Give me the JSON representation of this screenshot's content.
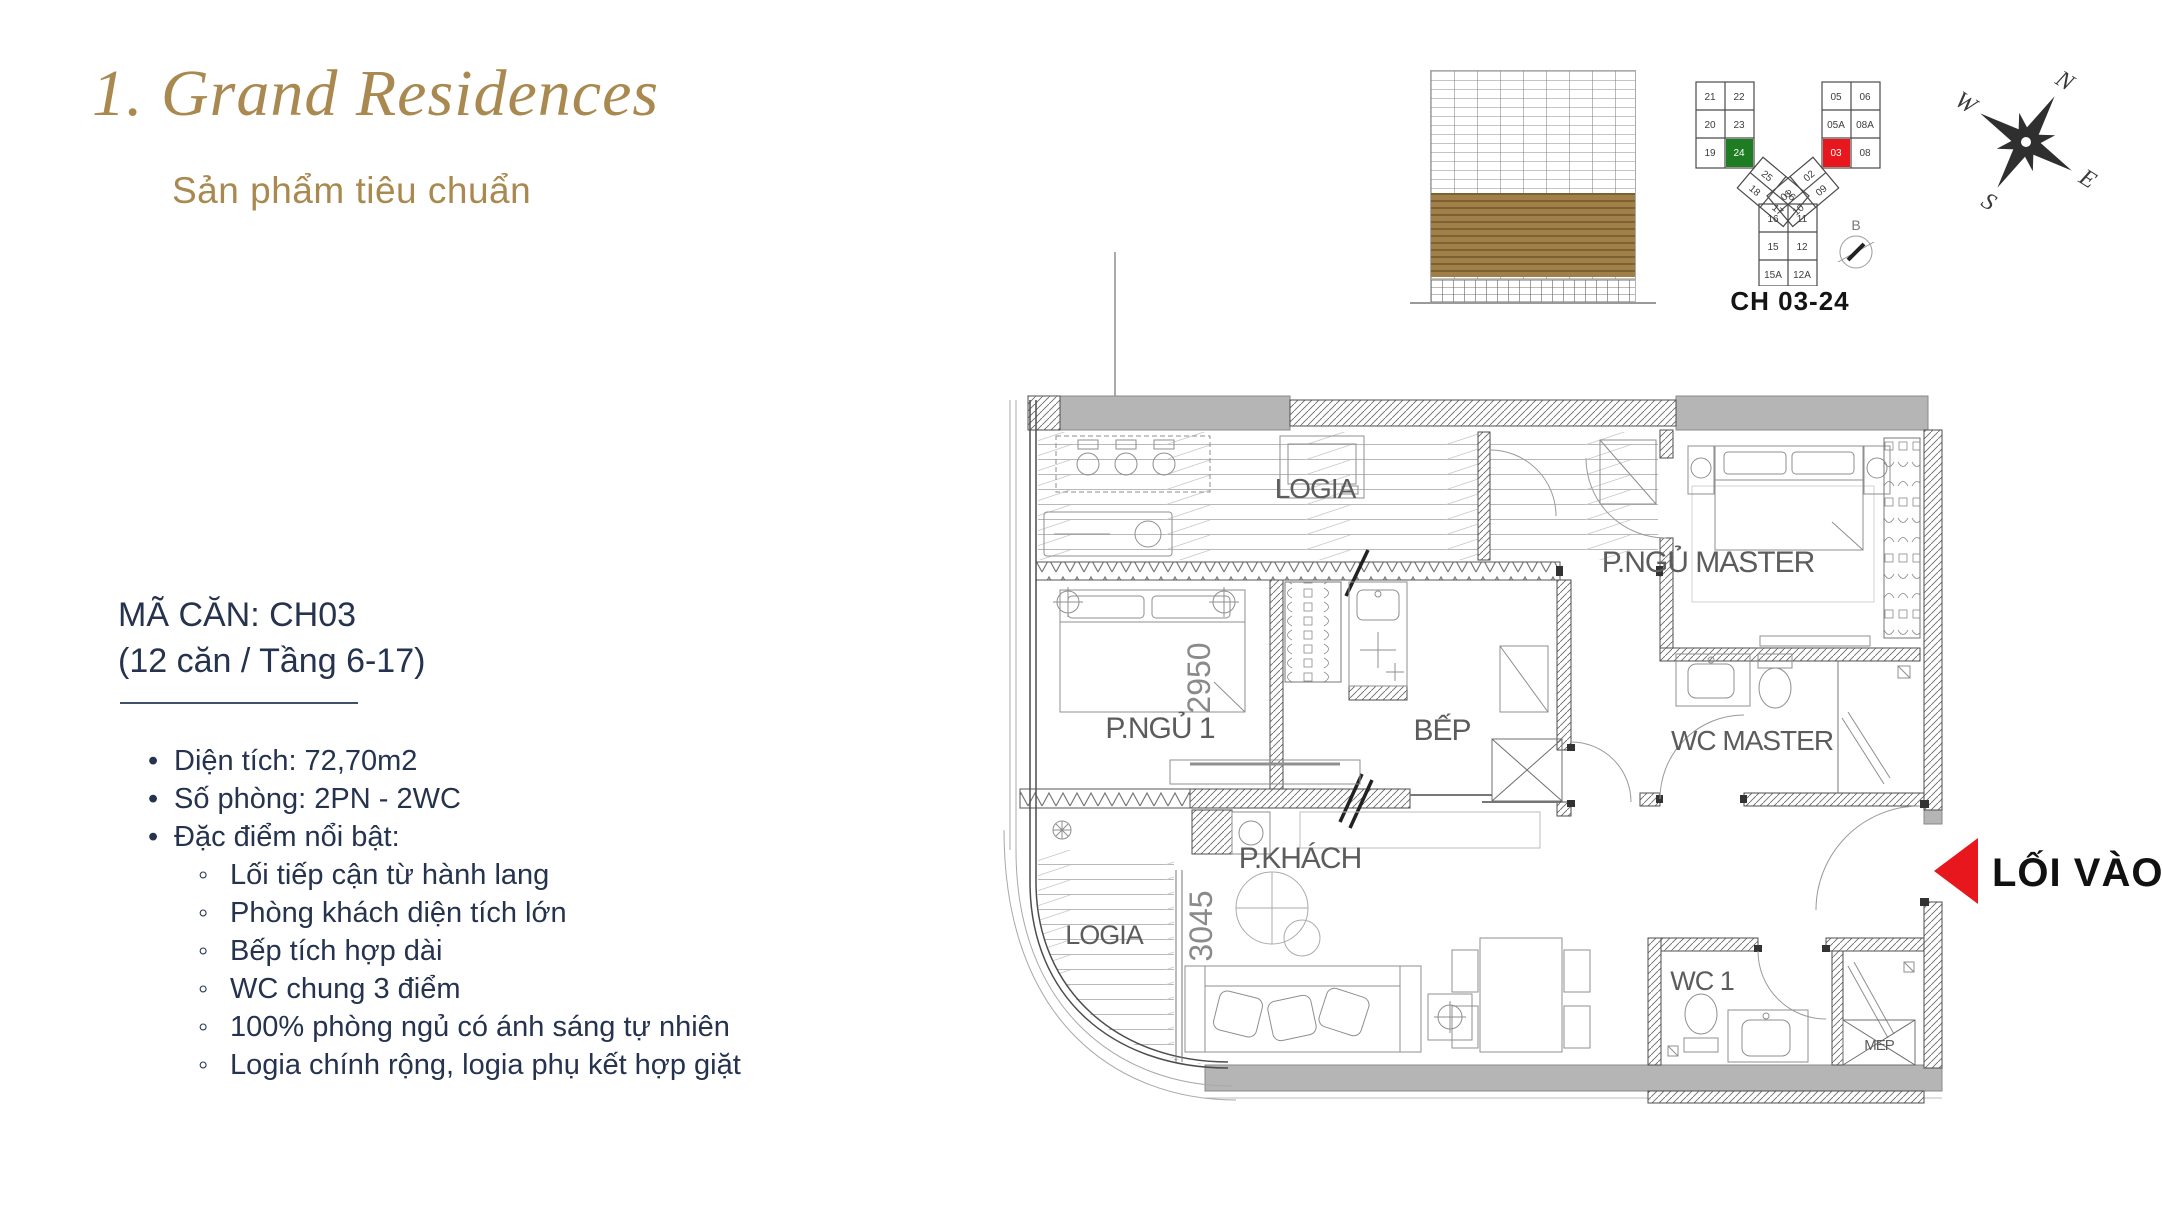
{
  "header": {
    "title": "1. Grand Residences",
    "subtitle": "Sản phẩm tiêu chuẩn"
  },
  "info": {
    "unit_code": "MÃ CĂN: CH03",
    "availability": "(12 căn / Tầng 6-17)",
    "features": [
      "Diện tích: 72,70m2",
      "Số phòng: 2PN - 2WC",
      "Đặc điểm nổi bật:"
    ],
    "details": [
      "Lối tiếp cận từ hành lang",
      "Phòng khách diện tích lớn",
      "Bếp tích hợp dài",
      "WC chung 3 điểm",
      "100% phòng ngủ có ánh sáng tự nhiên",
      "Logia chính rộng, logia phụ kết hợp giặt"
    ]
  },
  "keyplan": {
    "label": "CH 03-24",
    "section_mark": "B",
    "left_wing": [
      "21",
      "22",
      "20",
      "23",
      "19",
      "24"
    ],
    "right_wing": [
      "05",
      "06",
      "05A",
      "08A",
      "03",
      "08"
    ],
    "left_diag": [
      "25",
      "26",
      "18",
      "17"
    ],
    "right_diag": [
      "01",
      "02",
      "10",
      "09"
    ],
    "stem": [
      "16",
      "11",
      "15",
      "12",
      "15A",
      "12A"
    ],
    "highlight_green": "#1e7d23",
    "highlight_red": "#e8161d"
  },
  "compass": {
    "n": "N",
    "e": "E",
    "s": "S",
    "w": "W"
  },
  "plan": {
    "rooms": {
      "logia_top": "LOGIA",
      "master": "P.NGỦ MASTER",
      "bedroom1": "P.NGỦ 1",
      "kitchen": "BẾP",
      "wc_master": "WC MASTER",
      "living": "P.KHÁCH",
      "logia_bottom": "LOGIA",
      "wc1": "WC 1",
      "mep": "MEP"
    },
    "dims": {
      "bedroom": "2950",
      "living": "3045"
    },
    "entry_label": "LỐI VÀO"
  },
  "colors": {
    "accent_gold": "#a9894f",
    "navy": "#25334e",
    "entry_red": "#e8161d",
    "band_gold": "#96763c"
  }
}
